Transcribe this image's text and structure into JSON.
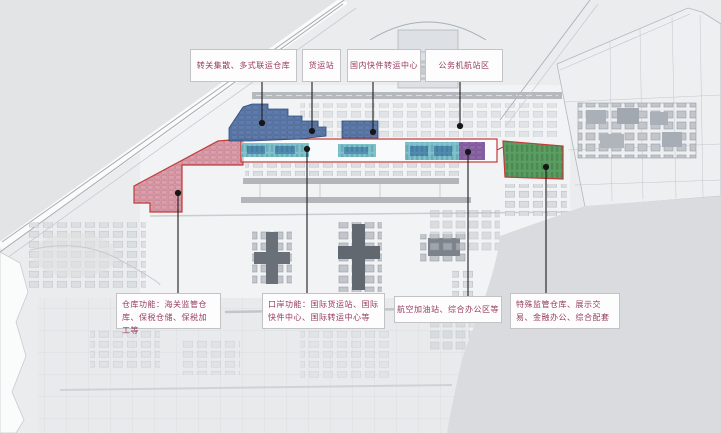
{
  "map": {
    "callouts_top": [
      {
        "id": "transfer-warehouse",
        "text": "转关集散、多式联运仓库"
      },
      {
        "id": "cargo-terminal",
        "text": "货运站"
      },
      {
        "id": "domestic-express-center",
        "text": "国内快件转运中心"
      },
      {
        "id": "business-aviation-area",
        "text": "公务机航站区"
      }
    ],
    "callouts_bottom": [
      {
        "id": "warehouse-functions",
        "text": "仓库功能：海关监管仓库、保税仓储、保税加工等"
      },
      {
        "id": "port-functions",
        "text": "口岸功能：国际货运站、国际快件中心、国际转运中心等"
      },
      {
        "id": "fuel-office-area",
        "text": "航空加油站、综合办公区等"
      },
      {
        "id": "special-supervision",
        "text": "特殊监管仓库、展示交易、金融办公、综合配套"
      }
    ],
    "zone_colors": {
      "blue_zone": "#4e6fa3",
      "pink_zone": "#d98e9e",
      "cyan_zone": "#7cc3cd",
      "purple_zone": "#8a62a6",
      "green_zone": "#4d9855",
      "outline_red": "#c23b38"
    }
  }
}
